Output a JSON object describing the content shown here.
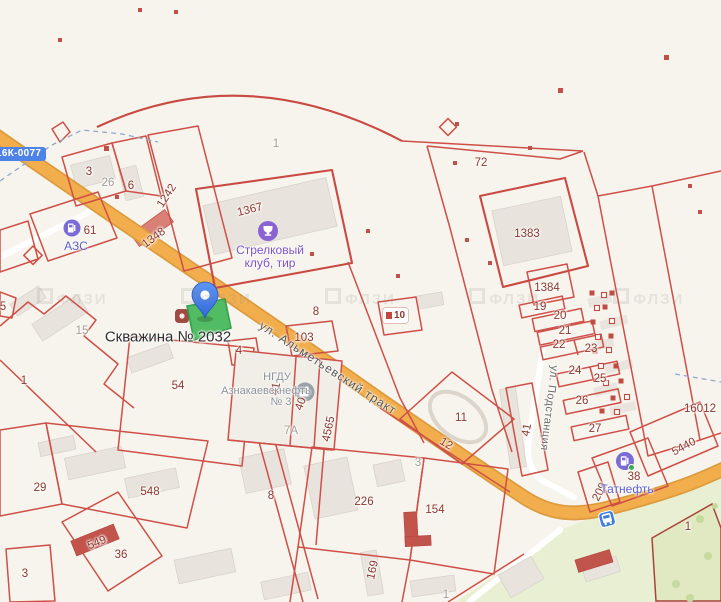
{
  "map": {
    "selected_label": "Скважина № 2032",
    "road_badge": "16К-0077",
    "landmark_chip": "10",
    "watermark": "ФЛЗИ",
    "streets": [
      {
        "name": "ул. Альметьевский тракт"
      },
      {
        "name": "ул. Подстанция"
      }
    ],
    "pois": [
      {
        "id": "azs",
        "label": "АЗС",
        "icon": "fuel-station"
      },
      {
        "id": "shooting-club",
        "line1": "Стрелковый",
        "line2": "клуб, тир",
        "icon": "trophy"
      },
      {
        "id": "ngdu",
        "line1": "НГДУ",
        "line2": "Азнакаевскнефть",
        "line3": "№ 3",
        "icon": "factory"
      },
      {
        "id": "tatneft",
        "label": "Татнефть",
        "icon": "fuel-station"
      }
    ],
    "marker": {
      "type": "pin",
      "attached_to": "Скважина № 2032"
    },
    "bus_stop": {
      "present": true
    },
    "colors": {
      "background": "#f7f4ee",
      "parcel_line": "#ce4f46",
      "parcel_label": "#8a372c",
      "road_fill": "#f2ae4d",
      "road_casing": "#dc9b3e",
      "selected_parcel": "#4cbb5f",
      "pin_blue": "#3d7ce4",
      "poi_purple": "#8a63d2",
      "poi_gray": "#99a0a8",
      "green_area": "#e9efd2",
      "building_gray": "#e8e4dd",
      "red_building": "#c1544b"
    },
    "parcel_labels": [
      {
        "t": "5",
        "x": 3,
        "y": 307
      },
      {
        "t": "3",
        "x": 89,
        "y": 172
      },
      {
        "t": "26",
        "x": 108,
        "y": 183,
        "c": "gray"
      },
      {
        "t": "6",
        "x": 131,
        "y": 186
      },
      {
        "t": "1242",
        "x": 167,
        "y": 196,
        "r": -57
      },
      {
        "t": "1348",
        "x": 154,
        "y": 238,
        "r": -36
      },
      {
        "t": "61",
        "x": 90,
        "y": 231
      },
      {
        "t": "1367",
        "x": 250,
        "y": 210,
        "r": -14
      },
      {
        "t": "1",
        "x": 276,
        "y": 144,
        "c": "gray"
      },
      {
        "t": "72",
        "x": 481,
        "y": 163
      },
      {
        "t": "8",
        "x": 316,
        "y": 312
      },
      {
        "t": "103",
        "x": 304,
        "y": 338
      },
      {
        "t": "1383",
        "x": 527,
        "y": 234
      },
      {
        "t": "1384",
        "x": 547,
        "y": 288
      },
      {
        "t": "19",
        "x": 540,
        "y": 307
      },
      {
        "t": "20",
        "x": 560,
        "y": 316
      },
      {
        "t": "21",
        "x": 565,
        "y": 331
      },
      {
        "t": "22",
        "x": 559,
        "y": 345
      },
      {
        "t": "23",
        "x": 591,
        "y": 349
      },
      {
        "t": "24",
        "x": 575,
        "y": 371
      },
      {
        "t": "25",
        "x": 600,
        "y": 379
      },
      {
        "t": "26",
        "x": 582,
        "y": 401
      },
      {
        "t": "27",
        "x": 595,
        "y": 429
      },
      {
        "t": "41",
        "x": 527,
        "y": 430,
        "r": -80
      },
      {
        "t": "16012",
        "x": 700,
        "y": 409
      },
      {
        "t": "5440",
        "x": 684,
        "y": 447,
        "r": -28
      },
      {
        "t": "38",
        "x": 634,
        "y": 477
      },
      {
        "t": "209",
        "x": 600,
        "y": 492,
        "r": -63
      },
      {
        "t": "1",
        "x": 688,
        "y": 527
      },
      {
        "t": "54",
        "x": 178,
        "y": 386
      },
      {
        "t": "4",
        "x": 239,
        "y": 351
      },
      {
        "t": "15",
        "x": 82,
        "y": 331,
        "c": "gray"
      },
      {
        "t": "1",
        "x": 24,
        "y": 381
      },
      {
        "t": "29",
        "x": 40,
        "y": 488
      },
      {
        "t": "548",
        "x": 150,
        "y": 492
      },
      {
        "t": "549",
        "x": 97,
        "y": 543,
        "r": -22
      },
      {
        "t": "36",
        "x": 121,
        "y": 555
      },
      {
        "t": "3",
        "x": 25,
        "y": 574
      },
      {
        "t": "8",
        "x": 271,
        "y": 496
      },
      {
        "t": "226",
        "x": 364,
        "y": 502
      },
      {
        "t": "154",
        "x": 435,
        "y": 510
      },
      {
        "t": "3",
        "x": 418,
        "y": 463,
        "c": "gray"
      },
      {
        "t": "169",
        "x": 373,
        "y": 570,
        "r": -78
      },
      {
        "t": "12",
        "x": 446,
        "y": 444,
        "r": 31
      },
      {
        "t": "11",
        "x": 461,
        "y": 418
      },
      {
        "t": "4565",
        "x": 329,
        "y": 429,
        "r": -78
      },
      {
        "t": "40",
        "x": 301,
        "y": 404,
        "r": -70
      },
      {
        "t": "41",
        "x": 276,
        "y": 389,
        "r": -80
      },
      {
        "t": "7А",
        "x": 291,
        "y": 431,
        "c": "gray"
      },
      {
        "t": "1",
        "x": 446,
        "y": 595,
        "c": "gray"
      }
    ]
  }
}
